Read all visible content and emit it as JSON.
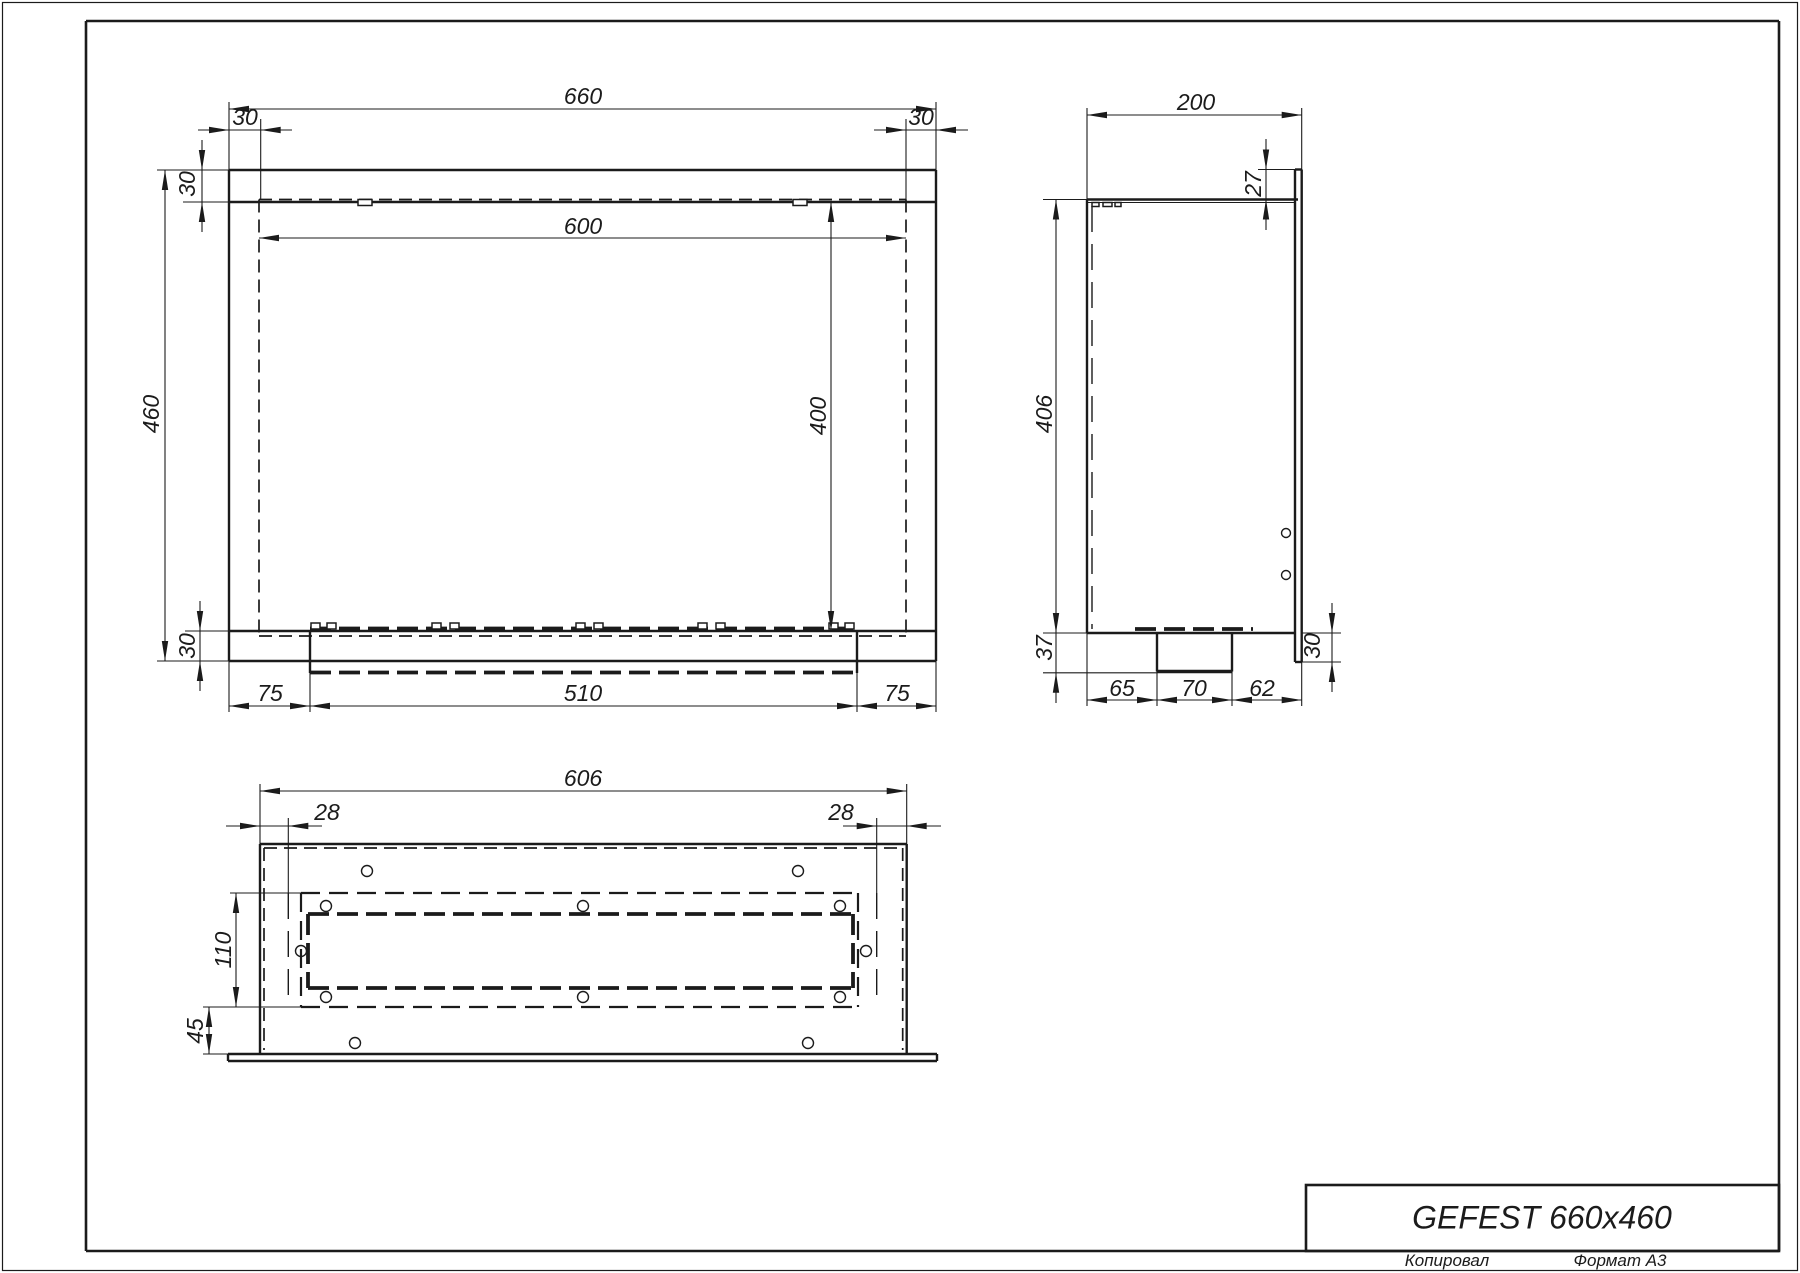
{
  "meta": {
    "width": 1800,
    "height": 1273,
    "bg": "#ffffff",
    "ink": "#1b1b1b"
  },
  "title_block": {
    "title": "GEFEST 660x460"
  },
  "footer": {
    "copied_label": "Копировал",
    "format_label": "Формат А3"
  },
  "drawing": {
    "styles": {
      "frame": {
        "w": 2.6,
        "name": "sheet-frame-line"
      },
      "contour": {
        "w": 2.4,
        "name": "part-edge"
      },
      "heavy": {
        "w": 3.5,
        "name": "part-edge-heavy"
      },
      "thin": {
        "w": 1.1,
        "name": "dimension-line"
      },
      "hidden": {
        "w": 1.7,
        "dash": "13,7",
        "name": "hidden-edge"
      },
      "centerdash": {
        "w": 1.4,
        "dash": "26,12",
        "name": "hidden-wall-line"
      },
      "band": {
        "w": 2.2,
        "dash": "19,9",
        "name": "burner-frame-hidden-edge"
      },
      "thickdash": {
        "w": 3.8,
        "dash": "21,8",
        "name": "burner-outline-hidden-edge"
      }
    },
    "boxes": [
      [
        2.5,
        2.5,
        1795,
        1268,
        1.2,
        "page-outer-border"
      ],
      [
        1306,
        1185,
        473,
        66,
        2.6,
        "title-block-box"
      ]
    ],
    "lines": {
      "frame": [
        [
          86,
          21,
          1779,
          21
        ],
        [
          86,
          21,
          86,
          1251
        ],
        [
          1779,
          21,
          1779,
          1251
        ],
        [
          86,
          1251,
          1779,
          1251
        ]
      ],
      "contour": [
        [
          229,
          170,
          936,
          170
        ],
        [
          229,
          661,
          936,
          661
        ],
        [
          229,
          170,
          229,
          661
        ],
        [
          936,
          170,
          936,
          661
        ],
        [
          229,
          202,
          936,
          202
        ],
        [
          229,
          631,
          936,
          631
        ],
        [
          310,
          631,
          310,
          673
        ],
        [
          857,
          631,
          857,
          673
        ],
        [
          1087,
          199.5,
          1298,
          199.5
        ],
        [
          1087,
          199.5,
          1087,
          633
        ],
        [
          1087,
          633,
          1295,
          633
        ],
        [
          1295,
          169.5,
          1295,
          662
        ],
        [
          1301.7,
          169.5,
          1301.7,
          662
        ],
        [
          1295,
          169.5,
          1301.7,
          169.5
        ],
        [
          1295,
          662,
          1301.7,
          662
        ],
        [
          1157,
          633,
          1157,
          671.5
        ],
        [
          1232,
          633,
          1232,
          671.5
        ],
        [
          260,
          844,
          906.7,
          844
        ],
        [
          260,
          844,
          260,
          1054
        ],
        [
          906.7,
          844,
          906.7,
          1054
        ],
        [
          228,
          1054,
          937,
          1054
        ],
        [
          228,
          1061,
          937,
          1061
        ],
        [
          228,
          1054,
          228,
          1061
        ],
        [
          937,
          1054,
          937,
          1061
        ]
      ],
      "heavy": [
        [
          1157,
          671.5,
          1232,
          671.5
        ]
      ],
      "thin": [
        [
          157,
          170,
          229,
          170
        ],
        [
          157,
          661,
          229,
          661
        ],
        [
          229,
          102,
          229,
          170
        ],
        [
          936,
          102,
          936,
          170
        ],
        [
          165,
          170,
          165,
          661
        ],
        [
          229,
          109,
          936,
          109
        ],
        [
          260.7,
          119,
          260.7,
          199.5
        ],
        [
          906,
          119,
          906,
          199.5
        ],
        [
          198,
          130,
          292,
          130
        ],
        [
          874,
          130,
          968,
          130
        ],
        [
          202,
          140,
          202,
          232
        ],
        [
          183,
          202,
          259,
          202
        ],
        [
          831,
          202,
          831,
          631
        ],
        [
          259,
          238,
          906,
          238
        ],
        [
          185,
          631,
          229,
          631
        ],
        [
          200,
          601,
          200,
          691
        ],
        [
          229,
          661,
          229,
          712
        ],
        [
          310,
          673,
          310,
          712
        ],
        [
          857,
          673,
          857,
          712
        ],
        [
          936,
          661,
          936,
          712
        ],
        [
          229,
          706,
          936,
          706
        ],
        [
          1087,
          202.5,
          1295,
          202.5
        ],
        [
          1087,
          108,
          1087,
          199.5
        ],
        [
          1301.7,
          108,
          1301.7,
          169.5
        ],
        [
          1087,
          115,
          1301.7,
          115
        ],
        [
          1258,
          169.5,
          1295,
          169.5
        ],
        [
          1266,
          139,
          1266,
          230
        ],
        [
          1043,
          199.5,
          1087,
          199.5
        ],
        [
          1043,
          633,
          1087,
          633
        ],
        [
          1056,
          199.5,
          1056,
          703
        ],
        [
          1043,
          672.8,
          1157,
          672.8
        ],
        [
          1302,
          633,
          1341,
          633
        ],
        [
          1302,
          662,
          1341,
          662
        ],
        [
          1332,
          603,
          1332,
          692
        ],
        [
          1087,
          633,
          1087,
          706
        ],
        [
          1157,
          671.5,
          1157,
          706
        ],
        [
          1232,
          671.5,
          1232,
          706
        ],
        [
          1301.7,
          662,
          1301.7,
          706
        ],
        [
          1087,
          700,
          1301.7,
          700
        ],
        [
          260,
          784,
          260,
          844
        ],
        [
          906.7,
          784,
          906.7,
          844
        ],
        [
          260,
          791,
          906.7,
          791
        ],
        [
          226,
          826,
          322,
          826
        ],
        [
          843,
          826,
          941,
          826
        ],
        [
          288.3,
          818,
          288.3,
          893
        ],
        [
          876.7,
          818,
          876.7,
          893
        ],
        [
          230,
          893,
          301,
          893
        ],
        [
          203,
          1007,
          301,
          1007
        ],
        [
          236,
          893,
          236,
          1007
        ],
        [
          203,
          1054,
          260,
          1054
        ],
        [
          209,
          1007,
          209,
          1054
        ]
      ],
      "hidden": [
        [
          259,
          199.5,
          906,
          199.5
        ],
        [
          259,
          199.5,
          259,
          636
        ],
        [
          906,
          199.5,
          906,
          636
        ],
        [
          259,
          636,
          906,
          636
        ],
        [
          264,
          848,
          902.7,
          848
        ],
        [
          264,
          848,
          264,
          1050
        ],
        [
          902.7,
          848,
          902.7,
          1050
        ]
      ],
      "centerdash": [
        [
          1092,
          206,
          1092,
          629
        ],
        [
          288.3,
          893,
          288.3,
          1007
        ],
        [
          876.7,
          893,
          876.7,
          1007
        ]
      ],
      "band": [
        [
          301,
          893,
          858,
          893
        ],
        [
          301,
          1007,
          858,
          1007
        ],
        [
          301,
          893,
          301,
          1007
        ],
        [
          858,
          893,
          858,
          1007
        ]
      ],
      "thickdash": [
        [
          310,
          628.5,
          857,
          628.5
        ],
        [
          310,
          672.5,
          857,
          672.5
        ],
        [
          308,
          914,
          853,
          914
        ],
        [
          308,
          988,
          853,
          988
        ],
        [
          308,
          914,
          308,
          988
        ],
        [
          853,
          914,
          853,
          988
        ],
        [
          1135,
          629,
          1253,
          629
        ]
      ]
    },
    "rects": [
      [
        358,
        199.5,
        14,
        6
      ],
      [
        793,
        199.5,
        14,
        6
      ],
      [
        311,
        623,
        9,
        6
      ],
      [
        327,
        623,
        9,
        6
      ],
      [
        432,
        623,
        9,
        6
      ],
      [
        450,
        623,
        9,
        6
      ],
      [
        576,
        623,
        9,
        6
      ],
      [
        594,
        623,
        9,
        6
      ],
      [
        698,
        623,
        9,
        6
      ],
      [
        716,
        623,
        9,
        6
      ],
      [
        829,
        623,
        9,
        6
      ],
      [
        845,
        623,
        9,
        6
      ],
      [
        1092,
        202.5,
        7,
        4
      ],
      [
        1103,
        202.5,
        9,
        4
      ],
      [
        1115,
        202.5,
        6,
        4
      ]
    ],
    "circles": [
      [
        367,
        871,
        5.5
      ],
      [
        798,
        871,
        5.5
      ],
      [
        326,
        906,
        5.5
      ],
      [
        583,
        906,
        5.5
      ],
      [
        840,
        906,
        5.5
      ],
      [
        301,
        951,
        5.5
      ],
      [
        866,
        951,
        5.5
      ],
      [
        326,
        997,
        5.5
      ],
      [
        583,
        997,
        5.5
      ],
      [
        840,
        997,
        5.5
      ],
      [
        355,
        1043,
        5.5
      ],
      [
        808,
        1043,
        5.5
      ],
      [
        1286,
        533,
        4.5
      ],
      [
        1286,
        575,
        4.5
      ]
    ],
    "arrows": [
      [
        229,
        109,
        "l"
      ],
      [
        936,
        109,
        "r"
      ],
      [
        229,
        130,
        "r"
      ],
      [
        260.7,
        130,
        "l"
      ],
      [
        906,
        130,
        "r"
      ],
      [
        936,
        130,
        "l"
      ],
      [
        202,
        170,
        "d"
      ],
      [
        202,
        202,
        "u"
      ],
      [
        165,
        170,
        "u"
      ],
      [
        165,
        661,
        "d"
      ],
      [
        259,
        238,
        "l"
      ],
      [
        906,
        238,
        "r"
      ],
      [
        831,
        202,
        "u"
      ],
      [
        831,
        631,
        "d"
      ],
      [
        200,
        631,
        "d"
      ],
      [
        200,
        661,
        "u"
      ],
      [
        229,
        706,
        "l"
      ],
      [
        310,
        706,
        "r"
      ],
      [
        310,
        706,
        "l"
      ],
      [
        857,
        706,
        "r"
      ],
      [
        857,
        706,
        "l"
      ],
      [
        936,
        706,
        "r"
      ],
      [
        1087,
        115,
        "l"
      ],
      [
        1301.7,
        115,
        "r"
      ],
      [
        1266,
        169.5,
        "d"
      ],
      [
        1266,
        199.5,
        "u"
      ],
      [
        1056,
        199.5,
        "u"
      ],
      [
        1056,
        633,
        "d"
      ],
      [
        1056,
        672.8,
        "u"
      ],
      [
        1332,
        633,
        "d"
      ],
      [
        1332,
        662,
        "u"
      ],
      [
        1087,
        700,
        "l"
      ],
      [
        1157,
        700,
        "r"
      ],
      [
        1157,
        700,
        "l"
      ],
      [
        1232,
        700,
        "r"
      ],
      [
        1232,
        700,
        "l"
      ],
      [
        1301.7,
        700,
        "r"
      ],
      [
        260,
        791,
        "l"
      ],
      [
        906.7,
        791,
        "r"
      ],
      [
        260,
        826,
        "r"
      ],
      [
        288.3,
        826,
        "l"
      ],
      [
        876.7,
        826,
        "r"
      ],
      [
        906.7,
        826,
        "l"
      ],
      [
        236,
        893,
        "u"
      ],
      [
        236,
        1007,
        "d"
      ],
      [
        209,
        1007,
        "u"
      ],
      [
        209,
        1054,
        "d"
      ]
    ],
    "labels": [
      [
        "660",
        583,
        96,
        0
      ],
      [
        "30",
        245,
        117,
        0
      ],
      [
        "30",
        921,
        117,
        0
      ],
      [
        "30",
        187,
        184,
        1
      ],
      [
        "460",
        151,
        414,
        1
      ],
      [
        "600",
        583,
        226,
        0
      ],
      [
        "400",
        818,
        416,
        1
      ],
      [
        "30",
        187,
        646,
        1
      ],
      [
        "75",
        270,
        693,
        0
      ],
      [
        "510",
        583,
        693,
        0
      ],
      [
        "75",
        897,
        693,
        0
      ],
      [
        "200",
        1196,
        102,
        0
      ],
      [
        "27",
        1253,
        184,
        1
      ],
      [
        "406",
        1044,
        414,
        1
      ],
      [
        "37",
        1044,
        648,
        1
      ],
      [
        "30",
        1312,
        646,
        1
      ],
      [
        "65",
        1122,
        688,
        0
      ],
      [
        "70",
        1194,
        688,
        0
      ],
      [
        "62",
        1262,
        688,
        0
      ],
      [
        "606",
        583,
        778,
        0
      ],
      [
        "28",
        327,
        812,
        0
      ],
      [
        "28",
        841,
        812,
        0
      ],
      [
        "110",
        223,
        950,
        1
      ],
      [
        "45",
        195,
        1031,
        1
      ]
    ]
  }
}
